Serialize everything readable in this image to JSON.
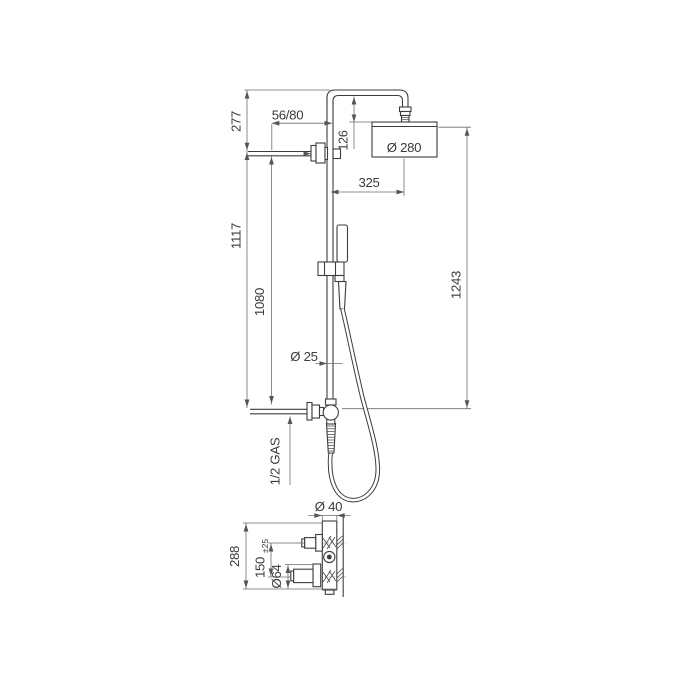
{
  "diagram": {
    "title": "shower-column-dimensioned-drawing",
    "labels": {
      "dim_277": "277",
      "dim_56_80": "56/80",
      "dim_126": "126",
      "dia_280": "Ø 280",
      "dim_325": "325",
      "dim_1117": "1117",
      "dim_1080": "1080",
      "dim_1243": "1243",
      "dia_25": "Ø 25",
      "gas_label": "1/2 GAS",
      "dia_40": "Ø 40",
      "dim_288": "288",
      "dim_150": "150",
      "tol_150": "±25",
      "dia_64": "Ø64"
    },
    "colors": {
      "line": "#3d3d3d",
      "dim": "#6e6e6e",
      "text": "#3a3a3a",
      "bg": "#ffffff"
    }
  }
}
